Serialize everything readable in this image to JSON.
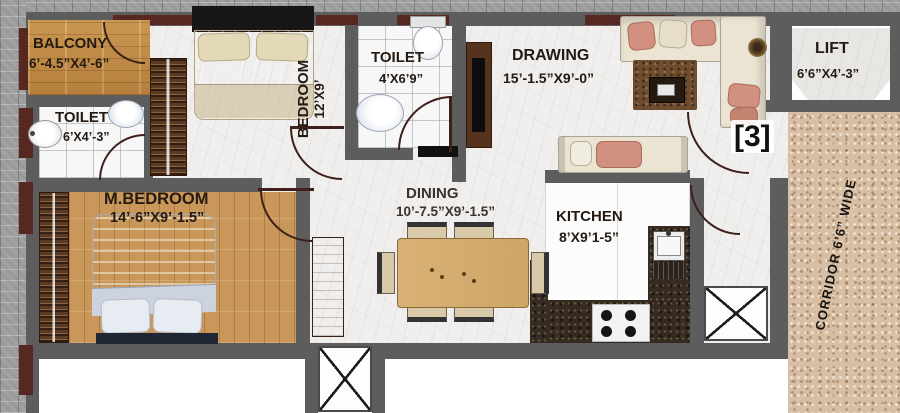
{
  "plan": {
    "unit_label": "[3]",
    "rooms": {
      "balcony": {
        "name": "BALCONY",
        "size": "6’-4.5”X4’-6”"
      },
      "toilet_left": {
        "name": "TOILET",
        "size": "6’X4’-3”"
      },
      "bedroom": {
        "name": "BEDROOM",
        "size": "12’X9’"
      },
      "toilet_mid": {
        "name": "TOILET",
        "size": "4’X6’9”"
      },
      "drawing": {
        "name": "DRAWING",
        "size": "15’-1.5”X9’-0”"
      },
      "lift": {
        "name": "LIFT",
        "size": "6’6”X4’-3”"
      },
      "master_bedroom": {
        "name": "M.BEDROOM",
        "size": "14’-6”X9’-1.5”"
      },
      "dining": {
        "name": "DINING",
        "size": "10’-7.5”X9’-1.5”"
      },
      "kitchen": {
        "name": "KITCHEN",
        "size": "8’X9’1-5”"
      }
    },
    "corridor_label": "CORRIDOR 6’6” WIDE",
    "colors": {
      "wall": "#5d5d5d",
      "window_marker": "#572722",
      "door_arc": "#3d2019",
      "wood_floor": "#c08a44",
      "marble_floor": "#f1efed",
      "corridor_granite": "#d8bfa4",
      "kitchen_counter": "#362b20",
      "label_text": "#241a12"
    }
  }
}
